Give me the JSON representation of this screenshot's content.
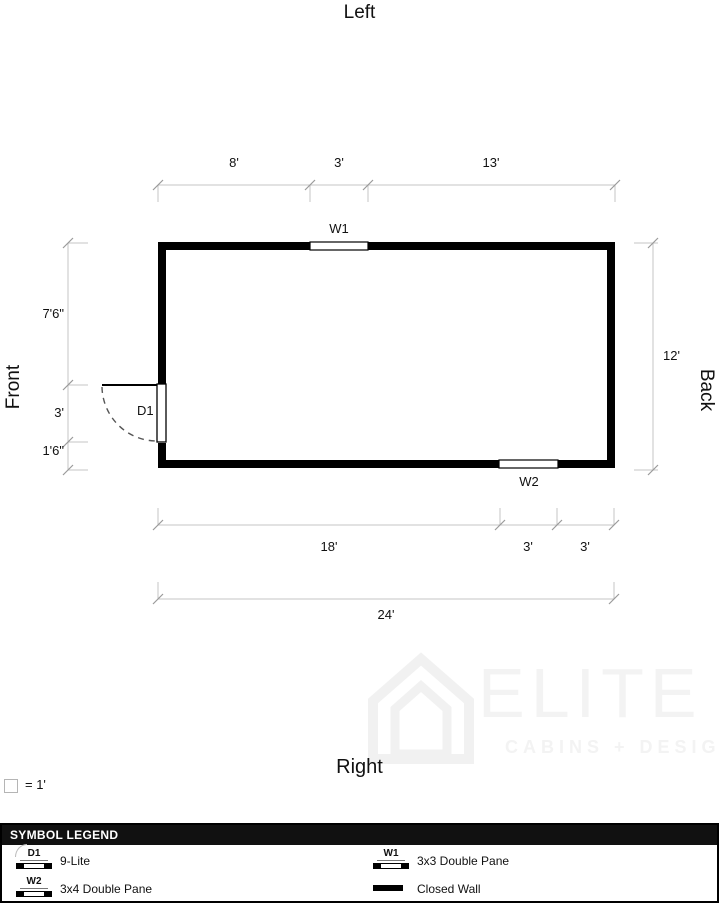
{
  "plan": {
    "side_labels": {
      "top": "Left",
      "bottom": "Right",
      "left": "Front",
      "right": "Back"
    },
    "top_dims": [
      "8'",
      "3'",
      "13'"
    ],
    "left_dims": [
      "7'6\"",
      "3'",
      "1'6\""
    ],
    "right_dim": "12'",
    "bottom_dims": [
      "18'",
      "3'",
      "3'"
    ],
    "overall_dim": "24'",
    "door_label": "D1",
    "window_top_label": "W1",
    "window_bottom_label": "W2"
  },
  "scale_note": "= 1'",
  "watermark": {
    "title": "ELITE",
    "subtitle": "CABINS + DESIGN"
  },
  "legend": {
    "header": "SYMBOL LEGEND",
    "items": [
      {
        "symbol": "D1",
        "label": "9-Lite"
      },
      {
        "symbol": "W2",
        "label": "3x4 Double Pane"
      },
      {
        "symbol": "W1",
        "label": "3x3 Double Pane"
      },
      {
        "symbol": "",
        "label": "Closed Wall"
      }
    ]
  },
  "colors": {
    "wall": "#000000",
    "dimension_line": "#c4c4c4",
    "tick": "#9a9a9a",
    "legend_header_bg": "#111111",
    "watermark": "#f3f3f3"
  }
}
